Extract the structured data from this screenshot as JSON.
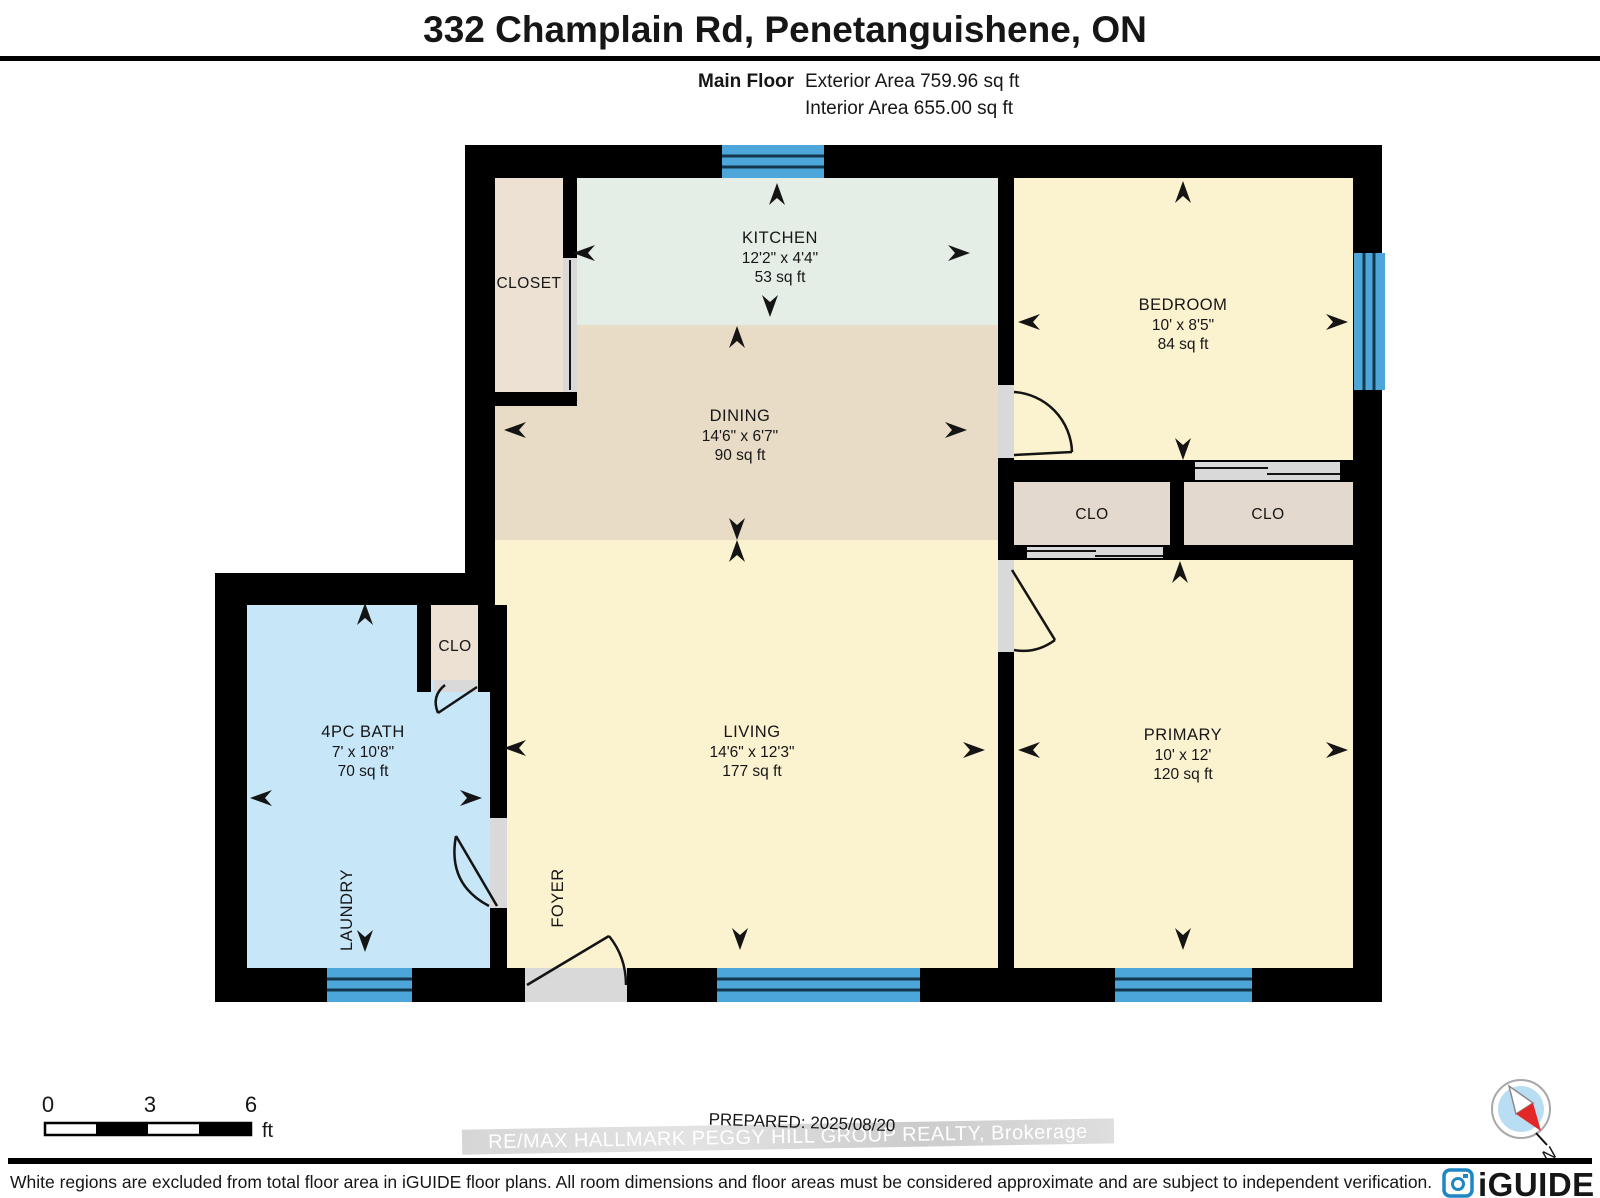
{
  "header": {
    "title": "332 Champlain Rd, Penetanguishene, ON",
    "floor_label": "Main Floor",
    "exterior_area": "Exterior Area 759.96 sq ft",
    "interior_area": "Interior Area 655.00 sq ft"
  },
  "rooms": {
    "kitchen": {
      "name": "KITCHEN",
      "dims": "12'2\" x 4'4\"",
      "area": "53 sq ft"
    },
    "dining": {
      "name": "DINING",
      "dims": "14'6\" x 6'7\"",
      "area": "90 sq ft"
    },
    "living": {
      "name": "LIVING",
      "dims": "14'6\" x 12'3\"",
      "area": "177 sq ft"
    },
    "bedroom": {
      "name": "BEDROOM",
      "dims": "10' x 8'5\"",
      "area": "84 sq ft"
    },
    "primary": {
      "name": "PRIMARY",
      "dims": "10' x 12'",
      "area": "120 sq ft"
    },
    "bath": {
      "name": "4PC BATH",
      "dims": "7' x 10'8\"",
      "area": "70 sq ft"
    },
    "closet": {
      "name": "CLOSET"
    },
    "clo_left": {
      "name": "CLO"
    },
    "clo_right": {
      "name": "CLO"
    },
    "clo_bath": {
      "name": "CLO"
    },
    "laundry": {
      "name": "LAUNDRY"
    },
    "foyer": {
      "name": "FOYER"
    }
  },
  "scale_bar": {
    "start": "0",
    "mid": "3",
    "end": "6",
    "unit": "ft"
  },
  "annotations": {
    "prepared": "PREPARED: 2025/08/20",
    "watermark": "RE/MAX HALLMARK PEGGY HILL GROUP REALTY, Brokerage"
  },
  "compass": {
    "north_label": "N"
  },
  "brand": {
    "logo_text": "iGUIDE"
  },
  "footer": {
    "disclaimer": "White regions are excluded from total floor area in iGUIDE floor plans. All room dimensions and floor areas must be considered approximate and are subject to independent verification."
  },
  "colors": {
    "wall": "#000000",
    "kitchen": "#e5eee6",
    "dining": "#e8dcc7",
    "living": "#fbf2cf",
    "bedroom": "#fbf2cf",
    "primary": "#fbf2cf",
    "bath": "#c7e6f8",
    "closet": "#ece1d2",
    "clo": "#e3d9ce",
    "window": "#4da6d9",
    "opening": "#d9d9d9",
    "logo_blue": "#1e86c4",
    "compass_red": "#e32726",
    "compass_inner": "#b9ddf3"
  }
}
